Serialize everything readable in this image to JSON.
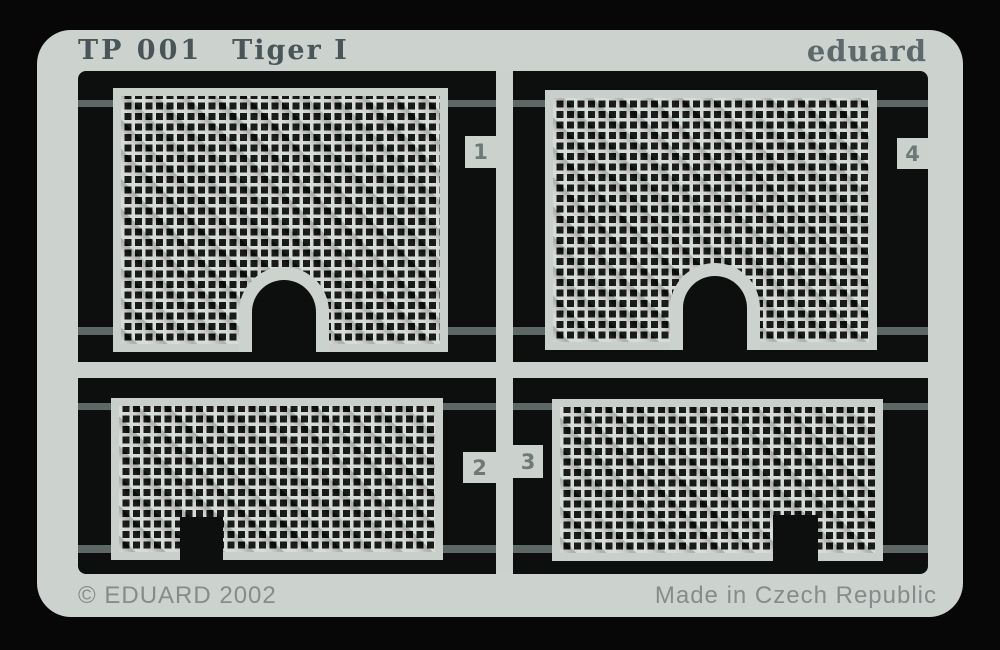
{
  "plate": {
    "code": "TP 001",
    "name": "Tiger I",
    "brand": "eduard",
    "copyright": "© EDUARD 2002",
    "made_in": "Made in Czech Republic"
  },
  "parts": [
    {
      "number": "1",
      "shape": "large mesh grille with arched cutout, top left"
    },
    {
      "number": "2",
      "shape": "wide short mesh grille with square notch left of center, bottom left"
    },
    {
      "number": "3",
      "shape": "wide short mesh grille with square notch right of center, bottom right"
    },
    {
      "number": "4",
      "shape": "large mesh grille with arched cutout, top right"
    }
  ],
  "colors": {
    "photo_background": "#070707",
    "fret_metal": "#ccd3cf",
    "interior_black": "#0c0f0e",
    "mesh_wire": "#d4dad6",
    "half_etched_line": "#5d6765",
    "code_text": "#4a5558",
    "brand_text": "#5d696b",
    "footer_text": "#838d8b",
    "tag_number_text": "#6f7a78"
  }
}
